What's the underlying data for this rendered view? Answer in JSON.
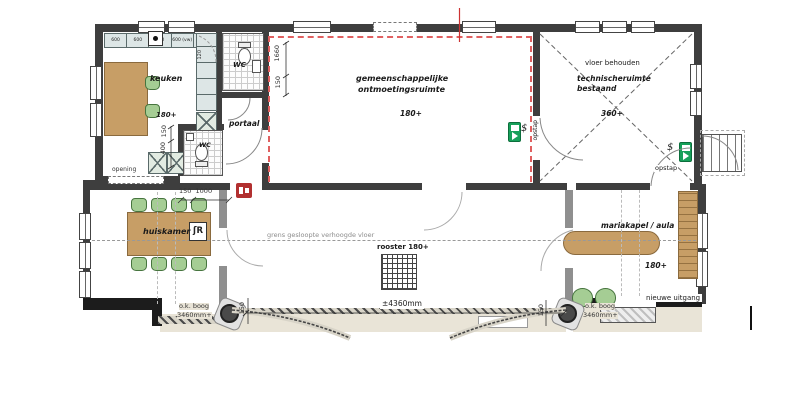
{
  "rooms": {
    "keuken": {
      "name": "keuken",
      "level": "180+"
    },
    "wc_top": "WC",
    "wc_bottom": "WC",
    "portaal": "portaal",
    "hall": {
      "name1": "gemeenschappelijke",
      "name2": "ontmoetingsruimte",
      "level": "180+"
    },
    "technical": {
      "note": "vloer behouden",
      "name1": "technischeruimte",
      "name2": "bestaand",
      "level": "360+"
    },
    "huiskamer": {
      "name": "huiskamer",
      "badge": "ʃR"
    },
    "mariakapel": {
      "name": "mariakapel / aula",
      "level": "180+",
      "exit": "nieuwe uitgang"
    }
  },
  "labels": {
    "grens": "grens gesloopte verhoogde vloer",
    "rooster": "rooster 180+",
    "span": "±4360mm",
    "boog": "o.k. boog",
    "boog_mm": "3460mm+",
    "opening": "opening",
    "opstap": "opstap",
    "dollar": "$"
  },
  "dims": {
    "d1660": "1660",
    "d150": "150",
    "d150_1000": "150  1000",
    "d400": "400"
  },
  "kitchen_units": [
    "600",
    "600",
    "600",
    "600 (vw)",
    "600"
  ],
  "cabinet_dim": "120",
  "colors": {
    "wall": "#3e3e3e",
    "new_wall_dashed": "#e06060",
    "wood": "#c79e66",
    "chair_green": "#a5cd94",
    "exit_green": "#17a05a",
    "fire_red": "#b23030",
    "porch_beige": "#e9e4d7"
  }
}
